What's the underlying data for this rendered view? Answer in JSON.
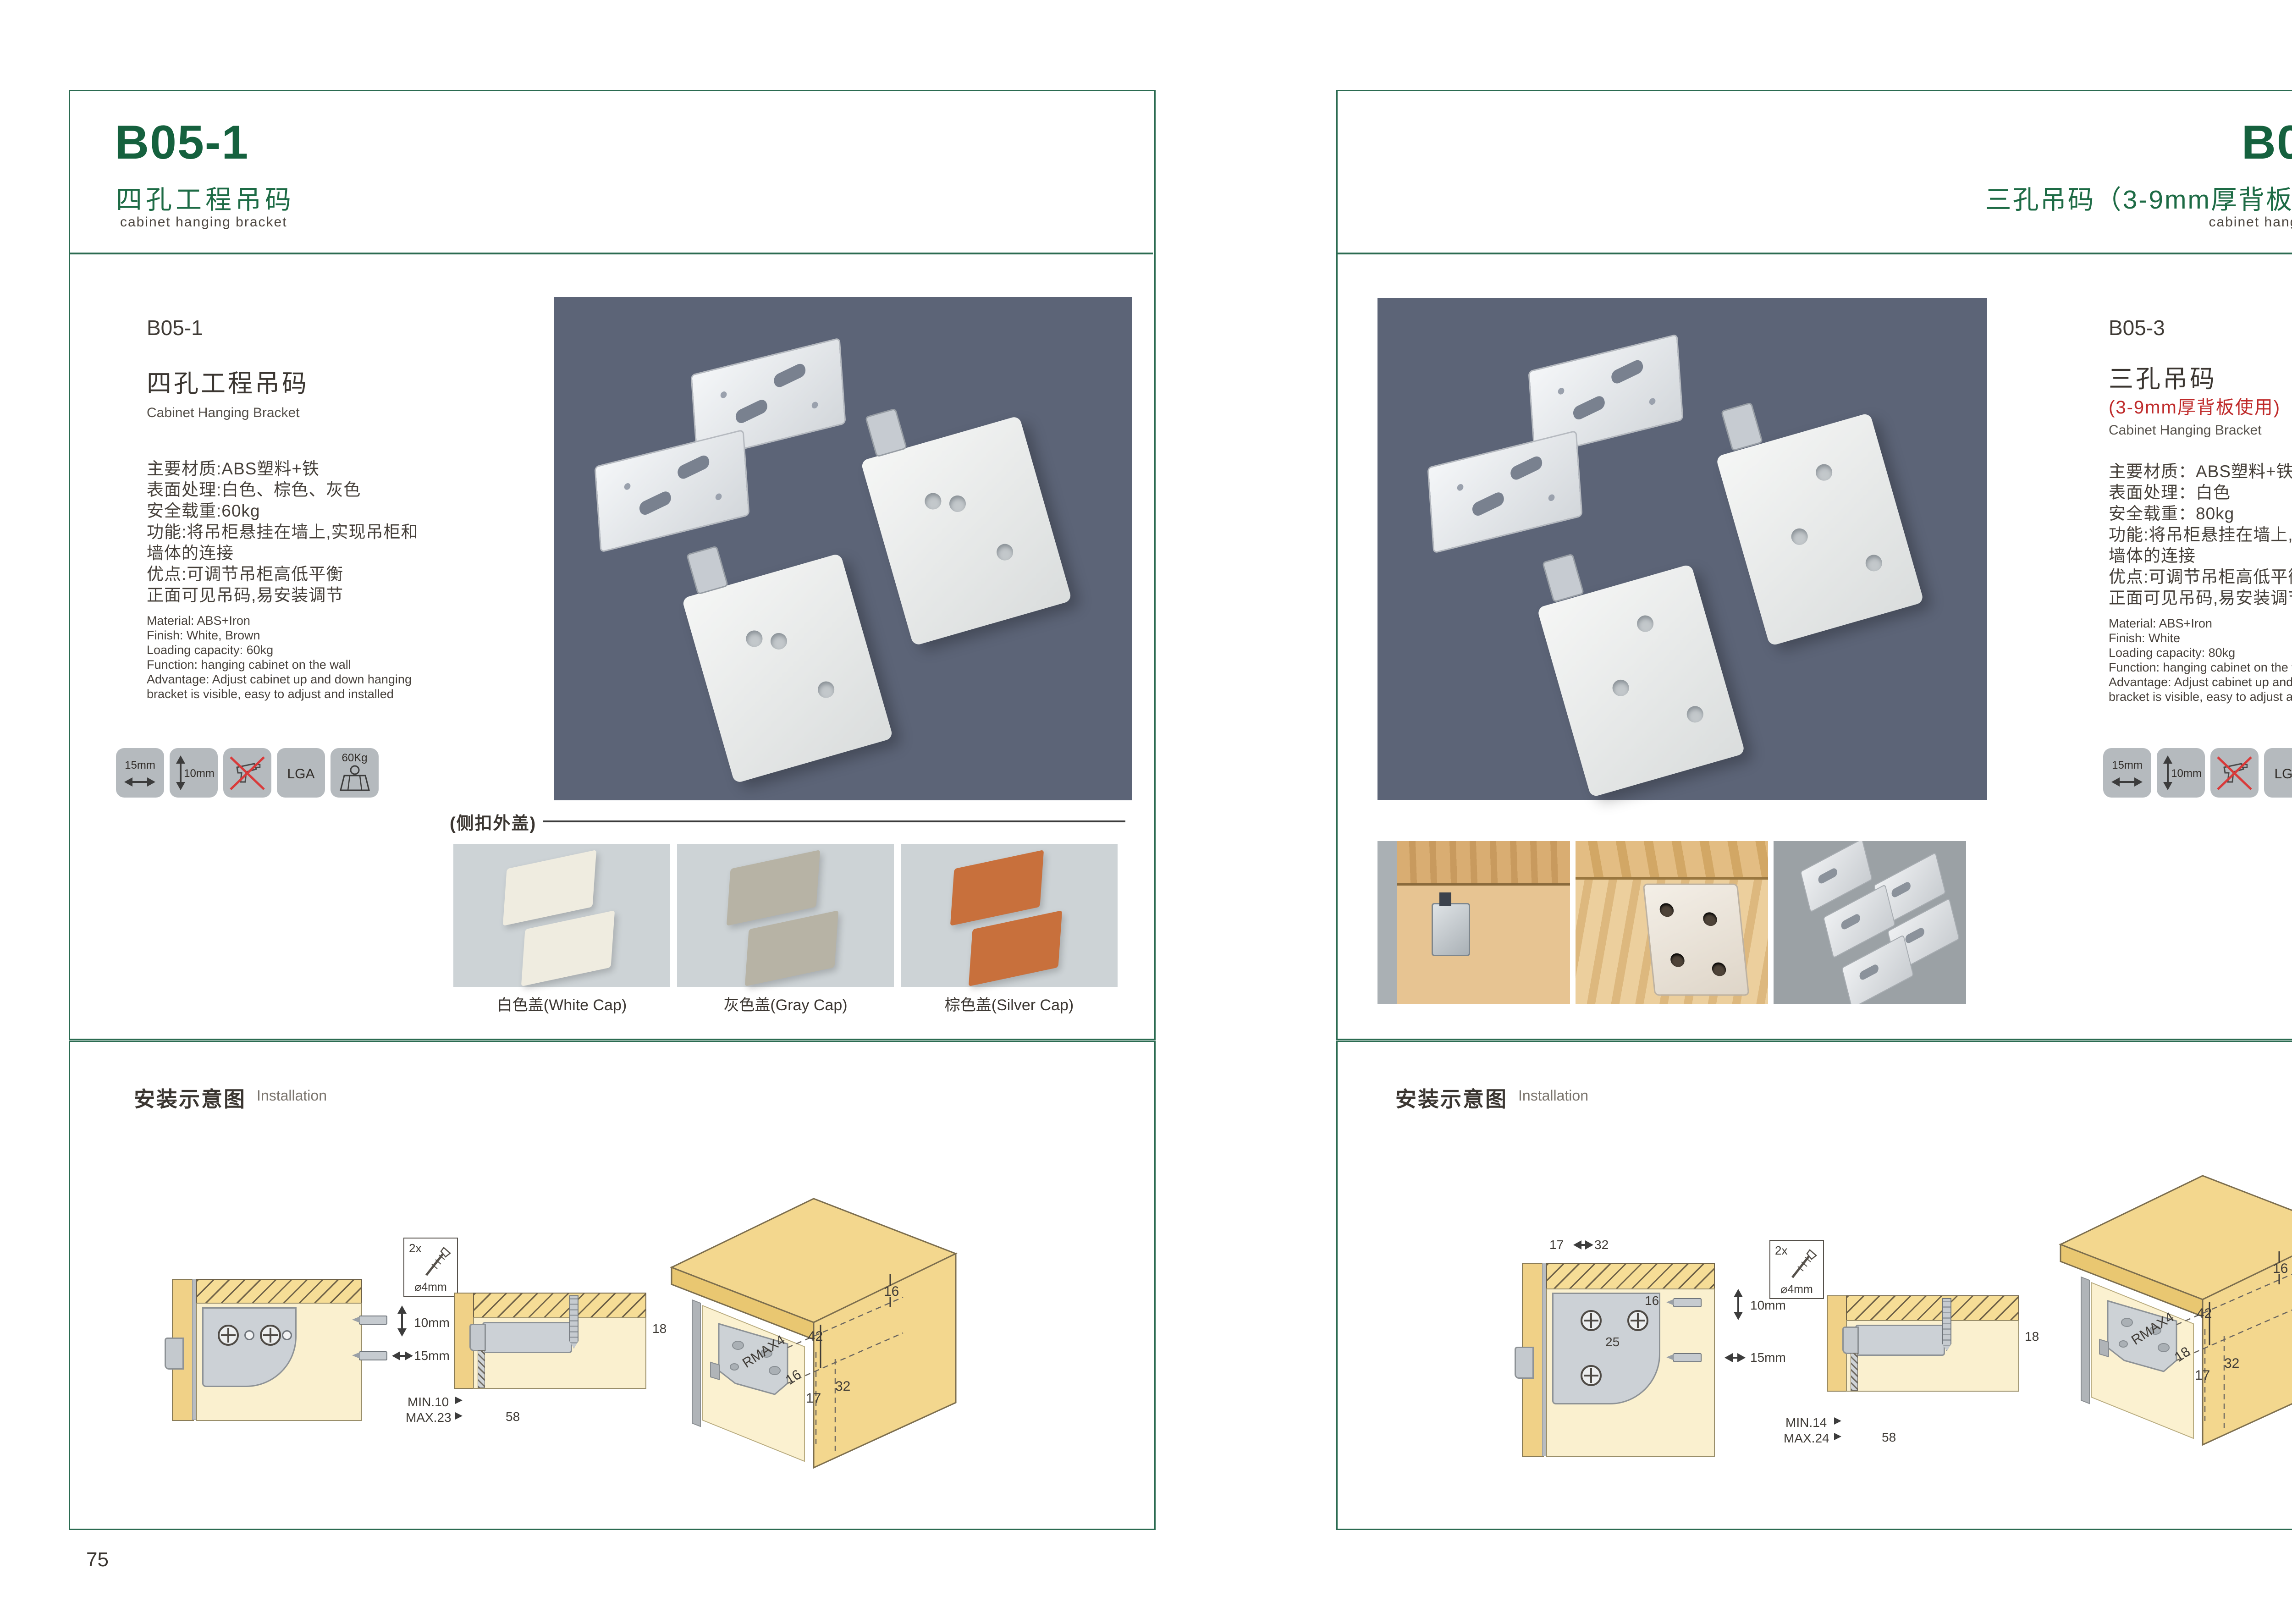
{
  "colors": {
    "brand_green": "#15613e",
    "frame_green": "#2b6b51",
    "accent_red": "#bf2a2a",
    "photo_background": "#5c6477",
    "icon_tile_gray": "#b5babe"
  },
  "left": {
    "header": {
      "code": "B05-1",
      "title_cn": "四孔工程吊码",
      "subtitle_en": "cabinet hanging bracket"
    },
    "body": {
      "code": "B05-1",
      "name_cn": "四孔工程吊码",
      "name_en": "Cabinet Hanging Bracket",
      "specs_cn": [
        "主要材质:ABS塑料+铁",
        "表面处理:白色、棕色、灰色",
        "安全载重:60kg",
        "功能:将吊柜悬挂在墙上,实现吊柜和",
        "墙体的连接",
        "优点:可调节吊柜高低平衡",
        "正面可见吊码,易安装调节"
      ],
      "specs_en": [
        "Material: ABS+Iron",
        "Finish: White, Brown",
        "Loading capacity: 60kg",
        "Function: hanging cabinet on the wall",
        "Advantage: Adjust cabinet up and down hanging",
        "bracket is visible, easy to adjust and installed"
      ]
    },
    "icons": [
      {
        "name": "panel-width-icon",
        "label": "15mm"
      },
      {
        "name": "panel-height-icon",
        "label": "10mm"
      },
      {
        "name": "no-drill-icon",
        "label": ""
      },
      {
        "name": "lga-cert-icon",
        "label": "LGA"
      },
      {
        "name": "load-weight-icon",
        "label": "60Kg"
      }
    ],
    "caps": {
      "section_label": "(侧扣外盖)",
      "items": [
        {
          "label": "白色盖(White Cap)",
          "color": "#efece0"
        },
        {
          "label": "灰色盖(Gray Cap)",
          "color": "#b7b3a5"
        },
        {
          "label": "棕色盖(Silver Cap)",
          "color": "#c8703c"
        }
      ]
    },
    "installation": {
      "title_cn": "安装示意图",
      "title_en": "Installation",
      "d1": {
        "dim_top": "10mm",
        "dim_bottom": "15mm"
      },
      "d2": {
        "qty": "2x",
        "diameter": "⌀4mm",
        "depth": "18",
        "min": "MIN.10",
        "max": "MAX.23",
        "width": "58"
      },
      "d3": {
        "edge": "16",
        "height": "42",
        "radius": "RMAX4",
        "slot": "16",
        "off1": "17",
        "off2": "32"
      }
    },
    "page_number": "75"
  },
  "right": {
    "header": {
      "code": "B05-3",
      "title_cn": "三孔吊码（3-9mm厚背板使用）",
      "subtitle_en": "cabinet hanging bracket"
    },
    "body": {
      "code": "B05-3",
      "name_cn": "三孔吊码",
      "name_red": "(3-9mm厚背板使用)",
      "name_en": "Cabinet Hanging Bracket",
      "specs_cn": [
        "主要材质：ABS塑料+铁",
        "表面处理：白色",
        "安全载重：80kg",
        "功能:将吊柜悬挂在墙上,实现吊柜和",
        "墙体的连接",
        "优点:可调节吊柜高低平衡",
        "正面可见吊码,易安装调节"
      ],
      "specs_en": [
        "Material: ABS+Iron",
        "Finish: White",
        "Loading capacity: 80kg",
        "Function: hanging cabinet on the wall",
        "Advantage: Adjust cabinet up and down hanging",
        "bracket is visible, easy to adjust and installed"
      ]
    },
    "icons": [
      {
        "name": "panel-width-icon",
        "label": "15mm"
      },
      {
        "name": "panel-height-icon",
        "label": "10mm"
      },
      {
        "name": "no-drill-icon",
        "label": ""
      },
      {
        "name": "lga-cert-icon",
        "label": "LGA"
      },
      {
        "name": "load-weight-icon",
        "label": "80Kg"
      }
    ],
    "installation": {
      "title_cn": "安装示意图",
      "title_en": "Installation",
      "d1": {
        "top1": "17",
        "top2": "32",
        "hole": "16",
        "pitch": "25",
        "dim_top": "10mm",
        "dim_bottom": "15mm"
      },
      "d2": {
        "qty": "2x",
        "diameter": "⌀4mm",
        "depth": "18",
        "min": "MIN.14",
        "max": "MAX.24",
        "width": "58"
      },
      "d3": {
        "edge": "16",
        "height": "42",
        "radius": "RMAX4",
        "slot": "18",
        "off1": "17",
        "off2": "32"
      }
    },
    "page_number": "76"
  }
}
